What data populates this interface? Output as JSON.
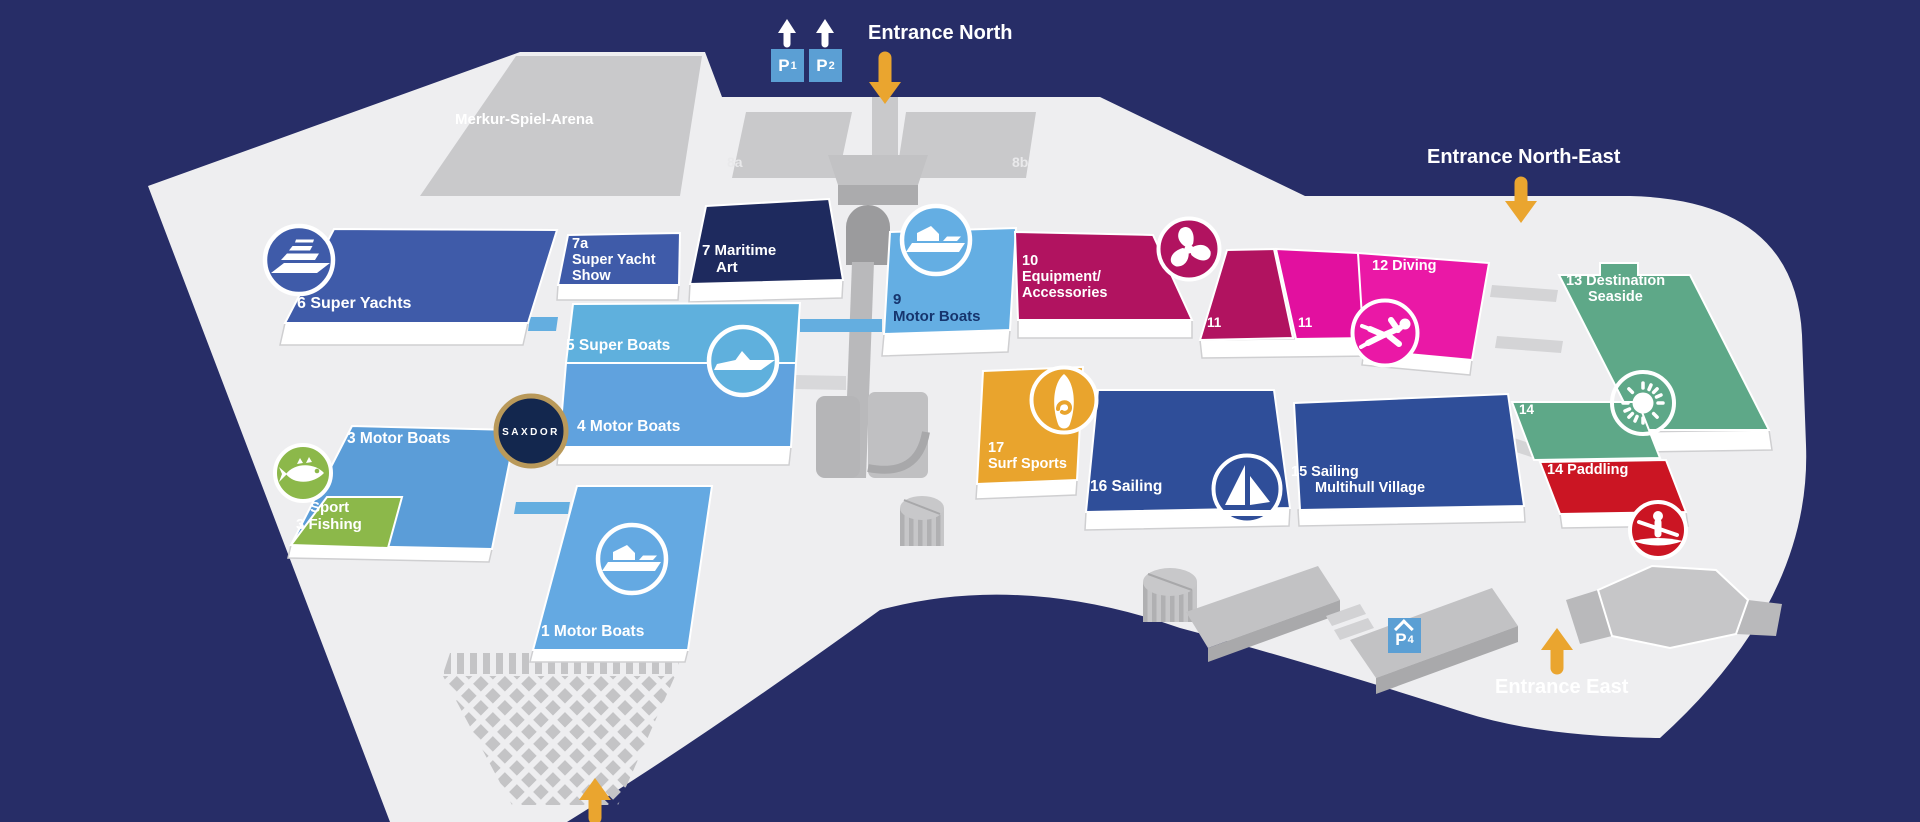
{
  "map": {
    "background_color": "#272d67",
    "floor_color": "#eeeef0",
    "building_gray": "#c9c9cb",
    "arrow_orange": "#eaa52f"
  },
  "entrances": {
    "north": "Entrance North",
    "north_east": "Entrance North-East",
    "east": "Entrance East"
  },
  "parking": {
    "p1": {
      "letter": "P",
      "num": "1"
    },
    "p2": {
      "letter": "P",
      "num": "2"
    },
    "p4": {
      "letter": "P",
      "num": "4"
    }
  },
  "landmarks": {
    "arena": "Merkur-Spiel-Arena",
    "hall_8a": "8a",
    "hall_8b": "8b"
  },
  "logos": {
    "saxdor": "SAXDOR"
  },
  "halls": {
    "h6": {
      "label": "6 Super Yachts",
      "color": "#3f5ba9",
      "icon": "yacht-icon"
    },
    "h7a": {
      "l1": "7a",
      "l2": "Super Yacht",
      "l3": "Show",
      "color": "#3f5ba9"
    },
    "h7": {
      "l1": "7 Maritime",
      "l2": "Art",
      "color": "#1e2a5e"
    },
    "h9": {
      "l1": "9",
      "l2": "Motor Boats",
      "color": "#64aee3",
      "icon": "motorboat-icon"
    },
    "h5": {
      "label": "5 Super Boats",
      "color": "#5fb0dd",
      "icon": "speedboat-icon"
    },
    "h4": {
      "label": "4 Motor Boats",
      "color": "#60a2de"
    },
    "h3": {
      "label": "3 Motor Boats",
      "color": "#5b9dd8"
    },
    "sport": {
      "l1": "Sport",
      "l2": "3 Fishing",
      "color": "#8cb84a",
      "icon": "fish-icon"
    },
    "h1": {
      "label": "1 Motor Boats",
      "color": "#64a9e2",
      "icon": "motorboat-icon"
    },
    "h10": {
      "l1": "10",
      "l2": "Equipment/",
      "l3": "Accessories",
      "color": "#b11360",
      "icon": "propeller-icon"
    },
    "h11a": {
      "label": "11",
      "color": "#b11360"
    },
    "h11b": {
      "label": "11",
      "color": "#e2109f"
    },
    "h12": {
      "label": "12 Diving",
      "color": "#ea18a6",
      "icon": "diver-icon"
    },
    "h13": {
      "l1": "13 Destination",
      "l2": "Seaside",
      "color": "#5ea888",
      "icon": "sun-icon"
    },
    "h14": {
      "label": "14",
      "color": "#5ea888"
    },
    "h14p": {
      "label": "14 Paddling",
      "color": "#cb1523",
      "icon": "kayak-icon"
    },
    "h17": {
      "l1": "17",
      "l2": "Surf Sports",
      "color": "#e9a42d",
      "icon": "surfboard-icon"
    },
    "h16": {
      "label": "16 Sailing",
      "color": "#2f4e99",
      "icon": "sailboat-icon"
    },
    "h15": {
      "l1": "15 Sailing",
      "l2": "Multihull Village",
      "color": "#2f4e99"
    }
  }
}
